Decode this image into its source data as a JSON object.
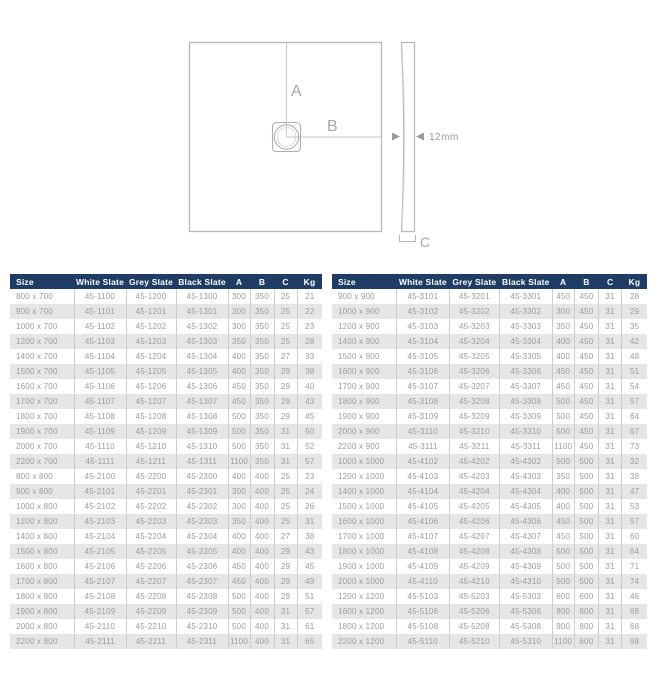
{
  "diagram": {
    "label_a": "A",
    "label_b": "B",
    "label_c": "C",
    "thickness_label": "12mm"
  },
  "tables": {
    "columns": [
      "Size",
      "White Slate",
      "Grey Slate",
      "Black Slate",
      "A",
      "B",
      "C",
      "Kg"
    ],
    "left": {
      "rows": [
        [
          "800 x 700",
          "45-1100",
          "45-1200",
          "45-1300",
          "300",
          "350",
          "25",
          "21"
        ],
        [
          "900 x 700",
          "45-1101",
          "45-1201",
          "45-1301",
          "300",
          "350",
          "25",
          "22"
        ],
        [
          "1000 x 700",
          "45-1102",
          "45-1202",
          "45-1302",
          "300",
          "350",
          "25",
          "23"
        ],
        [
          "1200 x 700",
          "45-1103",
          "45-1203",
          "45-1303",
          "350",
          "350",
          "25",
          "28"
        ],
        [
          "1400 x 700",
          "45-1104",
          "45-1204",
          "45-1304",
          "400",
          "350",
          "27",
          "33"
        ],
        [
          "1500 x 700",
          "45-1105",
          "45-1205",
          "45-1305",
          "400",
          "350",
          "29",
          "38"
        ],
        [
          "1600 x 700",
          "45-1106",
          "45-1206",
          "45-1306",
          "450",
          "350",
          "29",
          "40"
        ],
        [
          "1700 x 700",
          "45-1107",
          "45-1207",
          "45-1307",
          "450",
          "350",
          "29",
          "43"
        ],
        [
          "1800 x 700",
          "45-1108",
          "45-1208",
          "45-1308",
          "500",
          "350",
          "29",
          "45"
        ],
        [
          "1900 x 700",
          "45-1109",
          "45-1209",
          "45-1309",
          "500",
          "350",
          "31",
          "50"
        ],
        [
          "2000 x 700",
          "45-1110",
          "45-1210",
          "45-1310",
          "500",
          "350",
          "31",
          "52"
        ],
        [
          "2200 x 700",
          "45-1111",
          "45-1211",
          "45-1311",
          "1100",
          "350",
          "31",
          "57"
        ],
        [
          "800 x 800",
          "45-2100",
          "45-2200",
          "45-2300",
          "400",
          "400",
          "25",
          "23"
        ],
        [
          "900 x 800",
          "45-2101",
          "45-2201",
          "45-2301",
          "300",
          "400",
          "25",
          "24"
        ],
        [
          "1000 x 800",
          "45-2102",
          "45-2202",
          "45-2302",
          "300",
          "400",
          "25",
          "26"
        ],
        [
          "1200 x 800",
          "45-2103",
          "45-2203",
          "45-2303",
          "350",
          "400",
          "25",
          "31"
        ],
        [
          "1400 x 800",
          "45-2104",
          "45-2204",
          "45-2304",
          "400",
          "400",
          "27",
          "38"
        ],
        [
          "1500 x 800",
          "45-2105",
          "45-2205",
          "45-2305",
          "400",
          "400",
          "29",
          "43"
        ],
        [
          "1600 x 800",
          "45-2106",
          "45-2206",
          "45-2306",
          "450",
          "400",
          "29",
          "45"
        ],
        [
          "1700 x 800",
          "45-2107",
          "45-2207",
          "45-2307",
          "450",
          "400",
          "29",
          "49"
        ],
        [
          "1800 x 800",
          "45-2108",
          "45-2208",
          "45-2308",
          "500",
          "400",
          "29",
          "51"
        ],
        [
          "1900 x 800",
          "45-2109",
          "45-2209",
          "45-2309",
          "500",
          "400",
          "31",
          "57"
        ],
        [
          "2000 x 800",
          "45-2110",
          "45-2210",
          "45-2310",
          "500",
          "400",
          "31",
          "61"
        ],
        [
          "2200 x 800",
          "45-2111",
          "45-2211",
          "45-2311",
          "1100",
          "400",
          "31",
          "65"
        ]
      ]
    },
    "right": {
      "rows": [
        [
          "900 x 900",
          "45-3101",
          "45-3201",
          "45-3301",
          "450",
          "450",
          "31",
          "28"
        ],
        [
          "1000 x 900",
          "45-3102",
          "45-3202",
          "45-3302",
          "300",
          "450",
          "31",
          "29"
        ],
        [
          "1200 x 900",
          "45-3103",
          "45-3203",
          "45-3303",
          "350",
          "450",
          "31",
          "35"
        ],
        [
          "1400 x 900",
          "45-3104",
          "45-3204",
          "45-3304",
          "400",
          "450",
          "31",
          "42"
        ],
        [
          "1500 x 900",
          "45-3105",
          "45-3205",
          "45-3305",
          "400",
          "450",
          "31",
          "48"
        ],
        [
          "1600 x 900",
          "45-3106",
          "45-3206",
          "45-3306",
          "450",
          "450",
          "31",
          "51"
        ],
        [
          "1700 x 900",
          "45-3107",
          "45-3207",
          "45-3307",
          "450",
          "450",
          "31",
          "54"
        ],
        [
          "1800 x 900",
          "45-3108",
          "45-3208",
          "45-3308",
          "500",
          "450",
          "31",
          "57"
        ],
        [
          "1900 x 900",
          "45-3109",
          "45-3209",
          "45-3309",
          "500",
          "450",
          "31",
          "64"
        ],
        [
          "2000 x 900",
          "45-3110",
          "45-3210",
          "45-3310",
          "500",
          "450",
          "31",
          "67"
        ],
        [
          "2200 x 900",
          "45-3111",
          "45-3211",
          "45-3311",
          "1100",
          "450",
          "31",
          "73"
        ],
        [
          "1000 x 1000",
          "45-4102",
          "45-4202",
          "45-4302",
          "500",
          "500",
          "31",
          "32"
        ],
        [
          "1200 x 1000",
          "45-4103",
          "45-4203",
          "45-4303",
          "350",
          "500",
          "31",
          "38"
        ],
        [
          "1400 x 1000",
          "45-4104",
          "45-4204",
          "45-4304",
          "400",
          "500",
          "31",
          "47"
        ],
        [
          "1500 x 1000",
          "45-4105",
          "45-4205",
          "45-4305",
          "400",
          "500",
          "31",
          "53"
        ],
        [
          "1600 x 1000",
          "45-4106",
          "45-4206",
          "45-4306",
          "450",
          "500",
          "31",
          "57"
        ],
        [
          "1700 x 1000",
          "45-4107",
          "45-4207",
          "45-4307",
          "450",
          "500",
          "31",
          "60"
        ],
        [
          "1800 x 1000",
          "45-4108",
          "45-4208",
          "45-4308",
          "500",
          "500",
          "31",
          "64"
        ],
        [
          "1900 x 1000",
          "45-4109",
          "45-4209",
          "45-4309",
          "500",
          "500",
          "31",
          "71"
        ],
        [
          "2000 x 1000",
          "45-4110",
          "45-4210",
          "45-4310",
          "500",
          "500",
          "31",
          "74"
        ],
        [
          "1200 x 1200",
          "45-5103",
          "45-5203",
          "45-5303",
          "600",
          "600",
          "31",
          "46"
        ],
        [
          "1600 x 1200",
          "45-5106",
          "45-5206",
          "45-5306",
          "800",
          "800",
          "31",
          "68"
        ],
        [
          "1800 x 1200",
          "45-5108",
          "45-5208",
          "45-5308",
          "900",
          "800",
          "31",
          "68"
        ],
        [
          "2200 x 1200",
          "45-5110",
          "45-5210",
          "45-5310",
          "1100",
          "600",
          "31",
          "98"
        ]
      ]
    }
  },
  "colors": {
    "header_bg": "#1e3c64",
    "header_text": "#ffffff",
    "row_stripe": "#e6e6e6",
    "cell_text": "#9b9b9b",
    "diagram_line": "#b7b7b7",
    "diagram_label": "#a6a6a6"
  }
}
